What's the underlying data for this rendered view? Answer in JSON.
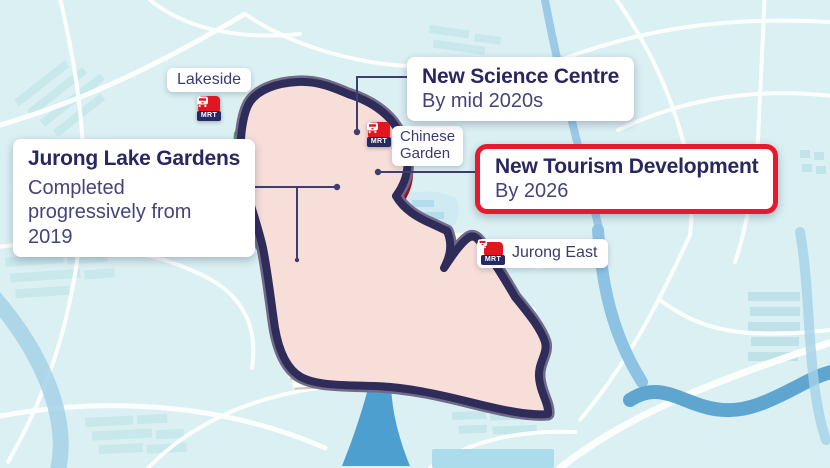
{
  "stations": {
    "lakeside": "Lakeside",
    "chinese_garden_line1": "Chinese",
    "chinese_garden_line2": "Garden",
    "jurong_east": "Jurong East",
    "mrt_badge": "MRT"
  },
  "callouts": {
    "jurong_lake_gardens": {
      "title": "Jurong Lake Gardens",
      "lines": [
        "Completed",
        "progressively from",
        "2019"
      ]
    },
    "new_science_centre": {
      "title": "New Science Centre",
      "subtitle": "By mid 2020s"
    },
    "new_tourism_development": {
      "title": "New Tourism Development",
      "subtitle": "By 2026"
    }
  },
  "colors": {
    "map_background": "#daf0f2",
    "map_blocks": "#c8e8eb",
    "road_white": "#ffffff",
    "river_blue": "#5ea6d0",
    "lake_blue": "#a9d7ec",
    "district_fill": "#f8ded9",
    "district_outline": "#302c5a",
    "park_green": "#4cb661",
    "park_green_dark": "#15714a",
    "tree_dot_green": "#0d5a3a",
    "science_site_orange": "#f4a91c",
    "tourism_site_red": "#e9192d",
    "mrt_red": "#e3151f",
    "mrt_navy": "#262a63",
    "label_navy": "#29275f",
    "body_navy": "#44447a",
    "tourism_border_red": "#e8192c"
  }
}
